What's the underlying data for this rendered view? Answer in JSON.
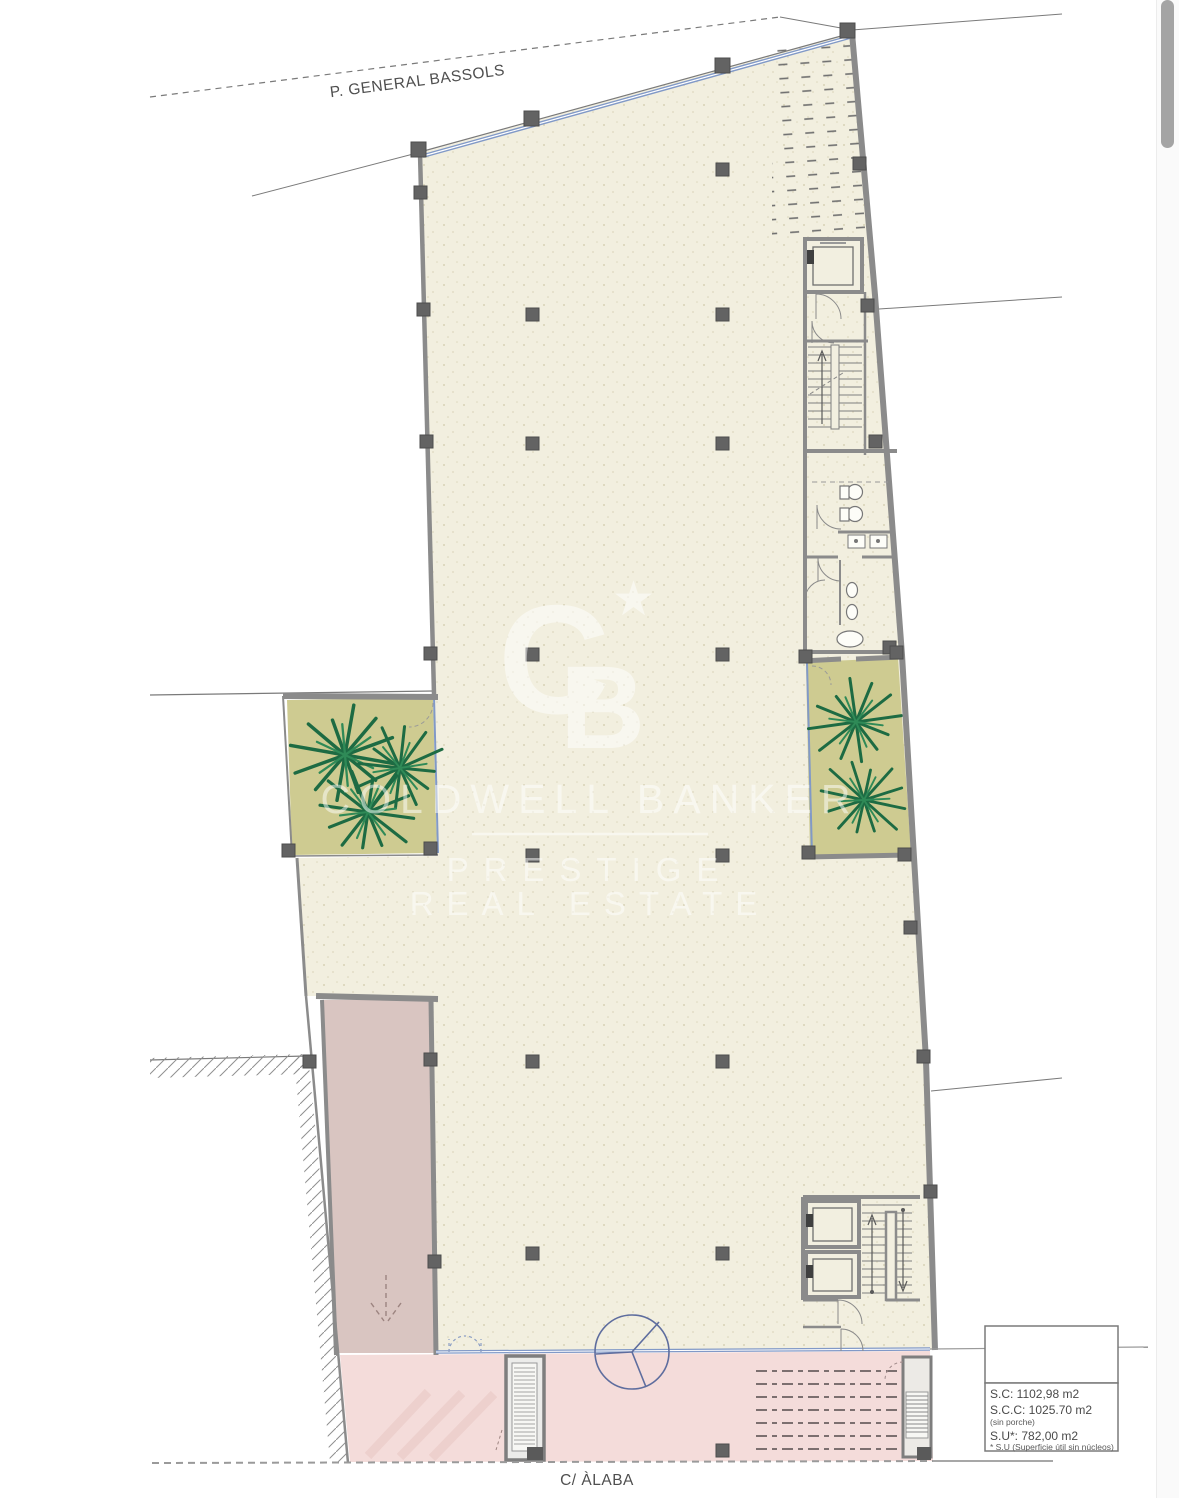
{
  "plan": {
    "streets": {
      "top": "P. GENERAL BASSOLS",
      "bottom": "C/ ÀLABA"
    },
    "legend": {
      "line1": "S.C:  1102,98 m2",
      "line2": "S.C.C: 1025.70 m2",
      "line3": "(sin porche)",
      "line4": "S.U*:  782,00 m2",
      "line5": "* S.U (Superficie útil sin núcleos)"
    },
    "watermark": {
      "monogram_c": "C",
      "monogram_b": "B",
      "star": "★",
      "brand": "COLDWELL BANKER",
      "tagline1": "PRESTIGE",
      "tagline2": "REAL ESTATE"
    },
    "colors": {
      "floor": "#f2efdf",
      "planter": "#cecb91",
      "ramp": "#d9c5c1",
      "porch": "#f4dcda",
      "glazing": "#8199c7",
      "wall": "#8b8b8b",
      "column": "#636363",
      "palm_dark": "#1d6b43",
      "palm_light": "#2f8a57"
    }
  }
}
